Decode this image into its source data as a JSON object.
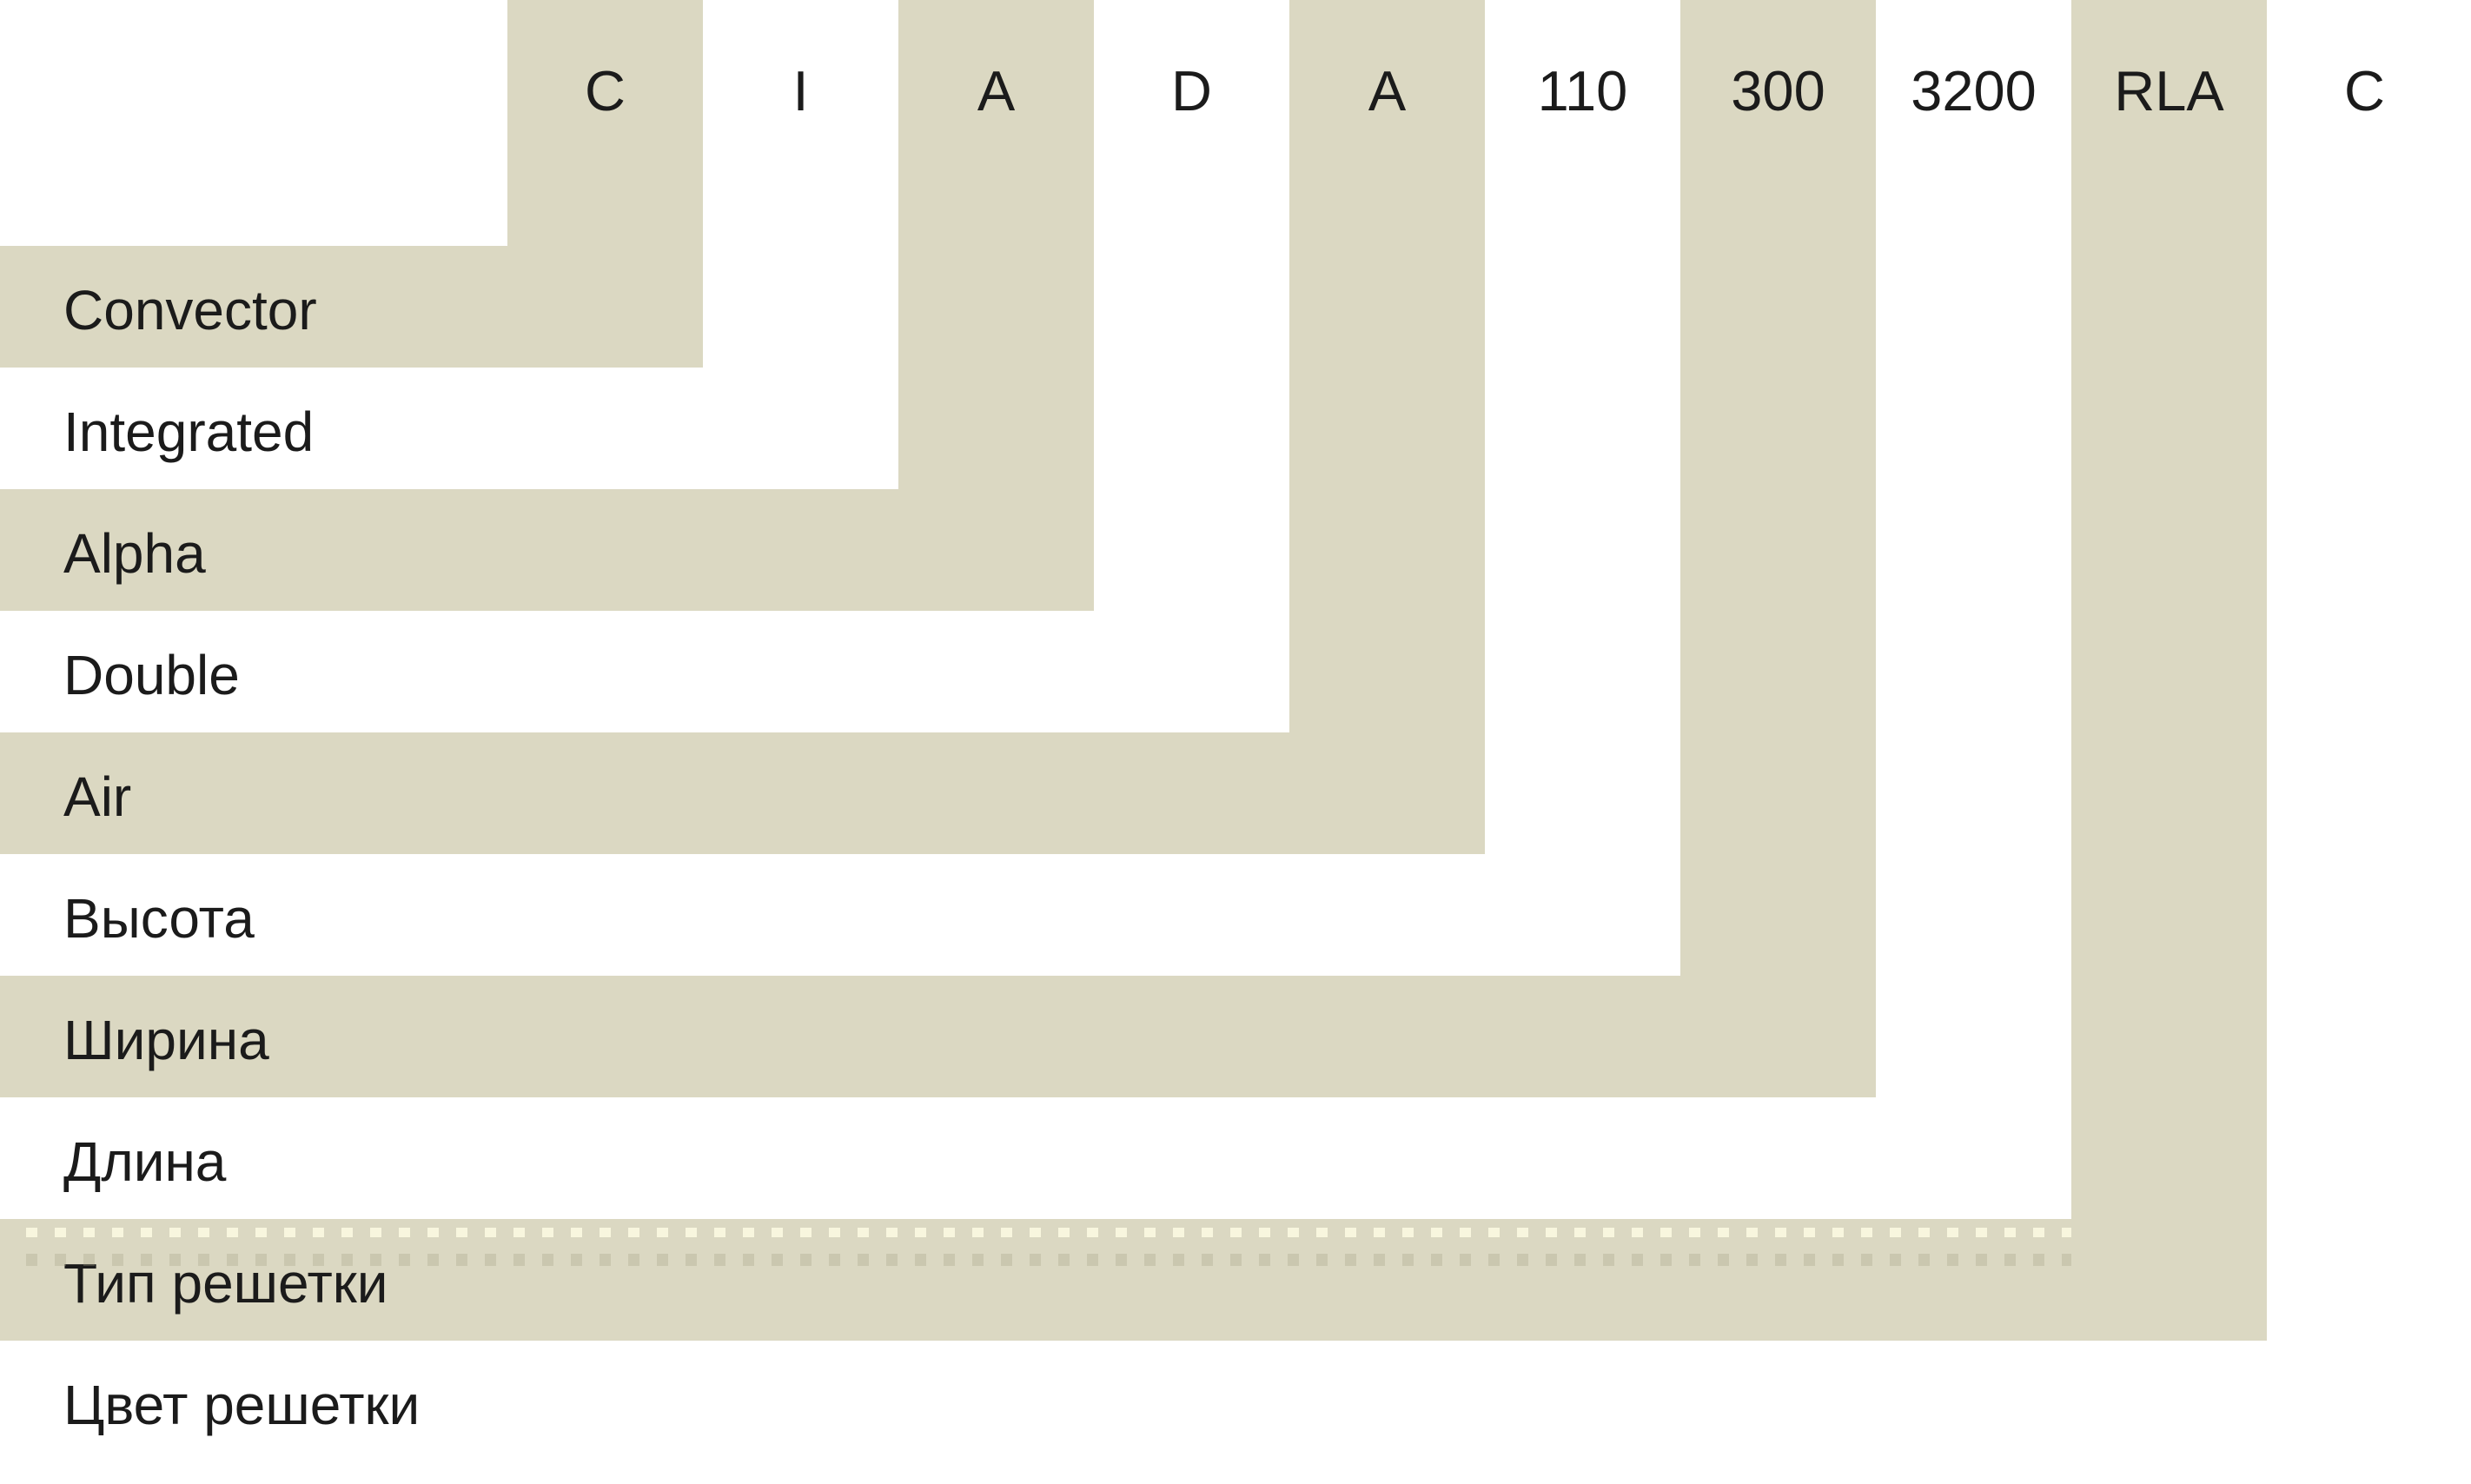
{
  "code_parts": [
    {
      "code": "C",
      "label": "Convector"
    },
    {
      "code": "I",
      "label": "Integrated"
    },
    {
      "code": "A",
      "label": "Alpha"
    },
    {
      "code": "D",
      "label": "Double"
    },
    {
      "code": "A",
      "label": "Air"
    },
    {
      "code": "110",
      "label": "Высота"
    },
    {
      "code": "300",
      "label": "Ширина"
    },
    {
      "code": "3200",
      "label": "Длина"
    },
    {
      "code": "RLA",
      "label": "Тип решетки"
    },
    {
      "code": "C",
      "label": "Цвет решетки"
    }
  ],
  "colors": {
    "band_beige": "#DBD8C2",
    "background": "#FFFFFF",
    "text": "#1B1B1B"
  }
}
